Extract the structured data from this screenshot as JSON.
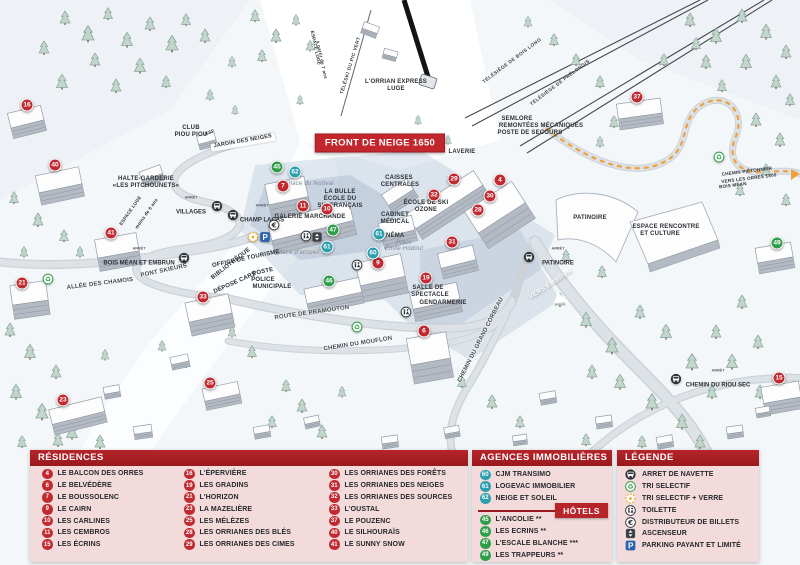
{
  "banner": {
    "text": "FRONT DE NEIGE 1650"
  },
  "colors": {
    "residence": "#c12a30",
    "hotel": "#2f9e49",
    "agency": "#2b9fae",
    "header_red": "#a81e23",
    "panel_pink": "#f2dbda",
    "banner_red": "#c1272d",
    "path_orange": "#eda13f"
  },
  "map": {
    "bus_stop_prefix": "ARRÊT",
    "markers": [
      {
        "n": "16",
        "x": 27,
        "y": 105,
        "type": "residence"
      },
      {
        "n": "40",
        "x": 55,
        "y": 165,
        "type": "residence"
      },
      {
        "n": "41",
        "x": 111,
        "y": 233,
        "type": "residence"
      },
      {
        "n": "21",
        "x": 22,
        "y": 283,
        "type": "residence"
      },
      {
        "n": "33",
        "x": 203,
        "y": 297,
        "type": "residence"
      },
      {
        "n": "23",
        "x": 63,
        "y": 400,
        "type": "residence"
      },
      {
        "n": "25",
        "x": 210,
        "y": 383,
        "type": "residence"
      },
      {
        "n": "7",
        "x": 283,
        "y": 186,
        "type": "residence"
      },
      {
        "n": "11",
        "x": 303,
        "y": 206,
        "type": "residence"
      },
      {
        "n": "10",
        "x": 327,
        "y": 209,
        "type": "residence"
      },
      {
        "n": "9",
        "x": 378,
        "y": 263,
        "type": "residence"
      },
      {
        "n": "6",
        "x": 424,
        "y": 331,
        "type": "residence"
      },
      {
        "n": "19",
        "x": 426,
        "y": 278,
        "type": "residence"
      },
      {
        "n": "31",
        "x": 452,
        "y": 242,
        "type": "residence"
      },
      {
        "n": "32",
        "x": 434,
        "y": 195,
        "type": "residence"
      },
      {
        "n": "29",
        "x": 454,
        "y": 179,
        "type": "residence"
      },
      {
        "n": "28",
        "x": 478,
        "y": 210,
        "type": "residence"
      },
      {
        "n": "30",
        "x": 490,
        "y": 196,
        "type": "residence"
      },
      {
        "n": "4",
        "x": 500,
        "y": 180,
        "type": "residence"
      },
      {
        "n": "37",
        "x": 637,
        "y": 97,
        "type": "residence"
      },
      {
        "n": "15",
        "x": 779,
        "y": 378,
        "type": "residence"
      },
      {
        "n": "45",
        "x": 277,
        "y": 167,
        "type": "hotel"
      },
      {
        "n": "47",
        "x": 333,
        "y": 230,
        "type": "hotel"
      },
      {
        "n": "46",
        "x": 329,
        "y": 281,
        "type": "hotel"
      },
      {
        "n": "49",
        "x": 777,
        "y": 243,
        "type": "hotel"
      },
      {
        "n": "62",
        "x": 295,
        "y": 172,
        "type": "agency"
      },
      {
        "n": "61",
        "x": 327,
        "y": 247,
        "type": "agency"
      },
      {
        "n": "61",
        "x": 379,
        "y": 234,
        "type": "agency"
      },
      {
        "n": "60",
        "x": 373,
        "y": 253,
        "type": "agency"
      }
    ],
    "labels": [
      {
        "t": "HALTE-GARDERIE",
        "x": 146,
        "y": 179,
        "r": 0,
        "c": "fac"
      },
      {
        "t": "«LES PITCHOUNETS»",
        "x": 146,
        "y": 186,
        "r": 0,
        "c": "fac"
      },
      {
        "t": "ESPACE LUGE",
        "x": 131,
        "y": 211,
        "r": -55,
        "c": "tiny"
      },
      {
        "t": "moins de 6 ans",
        "x": 147,
        "y": 214,
        "r": -55,
        "c": "tiny"
      },
      {
        "t": "CLUB",
        "x": 191,
        "y": 128,
        "r": 0,
        "c": "fac"
      },
      {
        "t": "PIOU PIOU",
        "x": 191,
        "y": 135,
        "r": 0,
        "c": "fac"
      },
      {
        "t": "ESF",
        "x": 210,
        "y": 133,
        "r": -20,
        "c": "tiny"
      },
      {
        "t": "JARDIN DES NEIGES",
        "x": 243,
        "y": 142,
        "r": -10,
        "c": "sign"
      },
      {
        "t": "ESPACE LUGE",
        "x": 315,
        "y": 48,
        "r": 78,
        "c": "tiny"
      },
      {
        "t": "à partir de 7 ans",
        "x": 321,
        "y": 60,
        "r": 78,
        "c": "tiny"
      },
      {
        "t": "TÉLÉSKI DU PIC VERT",
        "x": 352,
        "y": 66,
        "r": -73,
        "c": "lift"
      },
      {
        "t": "L'ORRIAN EXPRESS",
        "x": 396,
        "y": 82,
        "r": 0,
        "c": "fac"
      },
      {
        "t": "LUGE",
        "x": 396,
        "y": 89,
        "r": 0,
        "c": "fac"
      },
      {
        "t": "TÉLÉSIÈGE DE BOIS LONG",
        "x": 513,
        "y": 62,
        "r": -37,
        "c": "lift"
      },
      {
        "t": "TÉLÉSIÈGE DE PRÉLONGIS",
        "x": 561,
        "y": 84,
        "r": -37,
        "c": "lift"
      },
      {
        "t": "SEMLORE",
        "x": 517,
        "y": 119,
        "r": 0,
        "c": "fac"
      },
      {
        "t": "REMONTÉES MÉCANIQUES",
        "x": 541,
        "y": 126,
        "r": 0,
        "c": "fac"
      },
      {
        "t": "POSTE DE SECOURS",
        "x": 530,
        "y": 133,
        "r": 0,
        "c": "fac"
      },
      {
        "t": "LAVERIE",
        "x": 462,
        "y": 152,
        "r": 0,
        "c": "fac"
      },
      {
        "t": "CAISSES",
        "x": 399,
        "y": 178,
        "r": 0,
        "c": "fac"
      },
      {
        "t": "CENTRALES",
        "x": 400,
        "y": 185,
        "r": 0,
        "c": "fac"
      },
      {
        "t": "ÉCOLE DE SKI",
        "x": 426,
        "y": 203,
        "r": 0,
        "c": "fac"
      },
      {
        "t": "OZONE",
        "x": 426,
        "y": 210,
        "r": 0,
        "c": "fac"
      },
      {
        "t": "LA BULLE",
        "x": 340,
        "y": 192,
        "r": 0,
        "c": "fac"
      },
      {
        "t": "ÉCOLE DU",
        "x": 340,
        "y": 199,
        "r": 0,
        "c": "fac"
      },
      {
        "t": "SKI FRANÇAIS",
        "x": 340,
        "y": 206,
        "r": 0,
        "c": "fac"
      },
      {
        "t": "GALERIE MARCHANDE",
        "x": 310,
        "y": 217,
        "r": 0,
        "c": "fac"
      },
      {
        "t": "CABINET",
        "x": 395,
        "y": 215,
        "r": 0,
        "c": "fac"
      },
      {
        "t": "MÉDICAL",
        "x": 395,
        "y": 222,
        "r": 0,
        "c": "fac"
      },
      {
        "t": "CINÉMA",
        "x": 392,
        "y": 236,
        "r": 0,
        "c": "fac"
      },
      {
        "t": "Place du festival",
        "x": 310,
        "y": 184,
        "r": 0,
        "c": "place"
      },
      {
        "t": "Place d'accueil",
        "x": 298,
        "y": 253,
        "r": 0,
        "c": "place"
      },
      {
        "t": "Place",
        "x": 404,
        "y": 243,
        "r": 0,
        "c": "place"
      },
      {
        "t": "Émile Hodoul",
        "x": 404,
        "y": 249,
        "r": 0,
        "c": "place"
      },
      {
        "t": "OFFICE DE TOURISME",
        "x": 246,
        "y": 259,
        "r": -12,
        "c": "fac"
      },
      {
        "t": "POSTE",
        "x": 263,
        "y": 272,
        "r": -12,
        "c": "fac"
      },
      {
        "t": "BIBLIOTHÈQUE",
        "x": 231,
        "y": 264,
        "r": -38,
        "c": "fac"
      },
      {
        "t": "DÉPOSE CARS",
        "x": 235,
        "y": 283,
        "r": -24,
        "c": "fac"
      },
      {
        "t": "POLICE",
        "x": 263,
        "y": 280,
        "r": 0,
        "c": "fac"
      },
      {
        "t": "MUNICIPALE",
        "x": 272,
        "y": 287,
        "r": 0,
        "c": "fac"
      },
      {
        "t": "SALLE DE",
        "x": 428,
        "y": 288,
        "r": 0,
        "c": "fac"
      },
      {
        "t": "SPECTACLE",
        "x": 430,
        "y": 295,
        "r": 0,
        "c": "fac"
      },
      {
        "t": "GENDARMERIE",
        "x": 443,
        "y": 303,
        "r": 0,
        "c": "fac"
      },
      {
        "t": "PATINOIRE",
        "x": 590,
        "y": 218,
        "r": 0,
        "c": "fac"
      },
      {
        "t": "ESPACE RENCONTRE",
        "x": 666,
        "y": 227,
        "r": 0,
        "c": "fac"
      },
      {
        "t": "ET CULTURE",
        "x": 660,
        "y": 234,
        "r": 0,
        "c": "fac"
      },
      {
        "t": "CHEMIN PIÉTONNIER",
        "x": 747,
        "y": 172,
        "r": -7,
        "c": "tiny"
      },
      {
        "t": "VERS LES ORRES 1800",
        "x": 749,
        "y": 179,
        "r": -7,
        "c": "tiny"
      },
      {
        "t": "BOIS MÉAN",
        "x": 733,
        "y": 186,
        "r": -7,
        "c": "tiny"
      },
      {
        "t": "VERS EMBRUN",
        "x": 551,
        "y": 285,
        "r": -33,
        "c": "wroad"
      },
      {
        "t": "ALLÉE DES CHAMOIS",
        "x": 100,
        "y": 284,
        "r": -7,
        "c": "road"
      },
      {
        "t": "PONT SKIEURS",
        "x": 164,
        "y": 271,
        "r": -12,
        "c": "road"
      },
      {
        "t": "ROUTE DE PRAMOUTON",
        "x": 312,
        "y": 313,
        "r": -8,
        "c": "road"
      },
      {
        "t": "CHEMIN DU MOUFLON",
        "x": 358,
        "y": 344,
        "r": -9,
        "c": "road"
      },
      {
        "t": "CHEMIN DU GRAND CORBEAU",
        "x": 481,
        "y": 340,
        "r": -63,
        "c": "road"
      }
    ],
    "bus_stops": [
      {
        "label": "VILLAGES",
        "ix": 217,
        "iy": 206,
        "tx": 191,
        "ty": 207
      },
      {
        "label": "CHAMP LACAS",
        "ix": 233,
        "iy": 215,
        "tx": 262,
        "ty": 215
      },
      {
        "label": "BOIS MÉAN ET EMBRUN",
        "ix": 184,
        "iy": 258,
        "tx": 139,
        "ty": 258
      },
      {
        "label": "PATINOIRE",
        "ix": 529,
        "iy": 257,
        "tx": 558,
        "ty": 258
      },
      {
        "label": "CHEMIN DU RIOU SEC",
        "ix": 676,
        "iy": 379,
        "tx": 718,
        "ty": 380
      }
    ],
    "amenities": [
      {
        "type": "recycle",
        "x": 48,
        "y": 279
      },
      {
        "type": "recycle",
        "x": 357,
        "y": 327
      },
      {
        "type": "recycle",
        "x": 719,
        "y": 157
      },
      {
        "type": "tri_verre",
        "x": 253,
        "y": 237
      },
      {
        "type": "parking",
        "x": 265,
        "y": 237
      },
      {
        "type": "euro",
        "x": 274,
        "y": 225
      },
      {
        "type": "wc",
        "x": 306,
        "y": 236
      },
      {
        "type": "wc",
        "x": 357,
        "y": 265
      },
      {
        "type": "wc",
        "x": 406,
        "y": 312
      },
      {
        "type": "elevator",
        "x": 317,
        "y": 237
      }
    ]
  },
  "legend": {
    "residences": {
      "title": "RÉSIDENCES",
      "columns": [
        [
          {
            "n": "4",
            "label": "LE BALCON DES ORRES"
          },
          {
            "n": "6",
            "label": "LE BELVÉDÈRE"
          },
          {
            "n": "7",
            "label": "LE BOUSSOLENC"
          },
          {
            "n": "9",
            "label": "LE CAIRN"
          },
          {
            "n": "10",
            "label": "LES CARLINES"
          },
          {
            "n": "11",
            "label": "LES CEMBROS"
          },
          {
            "n": "15",
            "label": "LES ÉCRINS"
          }
        ],
        [
          {
            "n": "16",
            "label": "L'ÉPERVIÈRE"
          },
          {
            "n": "19",
            "label": "LES GRADINS"
          },
          {
            "n": "21",
            "label": "L'HORIZON"
          },
          {
            "n": "23",
            "label": "LA MAZELIÈRE"
          },
          {
            "n": "25",
            "label": "LES MÉLÈZES"
          },
          {
            "n": "28",
            "label": "LES ORRIANES DES BLÉS"
          },
          {
            "n": "29",
            "label": "LES ORRIANES DES CIMES"
          }
        ],
        [
          {
            "n": "30",
            "label": "LES ORRIANES DES FORÊTS"
          },
          {
            "n": "31",
            "label": "LES ORRIANES DES NEIGES"
          },
          {
            "n": "32",
            "label": "LES ORRIANES DES SOURCES"
          },
          {
            "n": "33",
            "label": "L'OUSTAL"
          },
          {
            "n": "37",
            "label": "LE POUZENC"
          },
          {
            "n": "40",
            "label": "LE SILHOURAÏS"
          },
          {
            "n": "41",
            "label": "LE SUNNY SNOW"
          }
        ]
      ]
    },
    "agences": {
      "title": "AGENCES IMMOBILIÈRES",
      "items": [
        {
          "n": "60",
          "label": "CJM TRANSIMO"
        },
        {
          "n": "61",
          "label": "LOGEVAC IMMOBILIER"
        },
        {
          "n": "62",
          "label": "NEIGE ET SOLEIL"
        }
      ]
    },
    "hotels": {
      "title": "HÔTELS",
      "items": [
        {
          "n": "45",
          "label": "L'ANCOLIE **"
        },
        {
          "n": "46",
          "label": "LES ECRINS **"
        },
        {
          "n": "47",
          "label": "L'ESCALE BLANCHE ***"
        },
        {
          "n": "49",
          "label": "LES TRAPPEURS **"
        }
      ]
    },
    "legende": {
      "title": "LÉGENDE",
      "items": [
        {
          "icon": "bus",
          "label": "ARRET DE NAVETTE"
        },
        {
          "icon": "recycle",
          "label": "TRI SELECTIF"
        },
        {
          "icon": "tri_verre",
          "label": "TRI SELECTIF + VERRE"
        },
        {
          "icon": "wc",
          "label": "TOILETTE"
        },
        {
          "icon": "euro",
          "label": "DISTRIBUTEUR DE BILLETS"
        },
        {
          "icon": "elevator",
          "label": "ASCENSEUR"
        },
        {
          "icon": "parking",
          "label": "PARKING PAYANT ET LIMITÉ"
        }
      ]
    }
  }
}
